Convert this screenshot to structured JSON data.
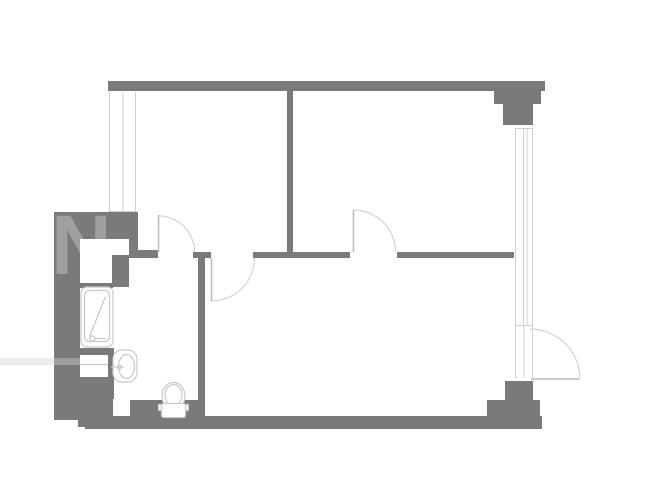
{
  "watermark": {
    "letter": "N"
  },
  "plan": {
    "colors": {
      "wall": "#7a7a7a",
      "window_line": "#cfcfcf",
      "door_arc": "#d4d4d4",
      "door_leaf": "#bcbcbc",
      "fixture_outline": "#c8c8c8",
      "watermark_text": "#9f9f9f",
      "background": "#ffffff"
    },
    "fixtures": [
      "bathtub",
      "sink",
      "toilet"
    ],
    "counts": {
      "doors": 4,
      "windows": 2
    }
  }
}
